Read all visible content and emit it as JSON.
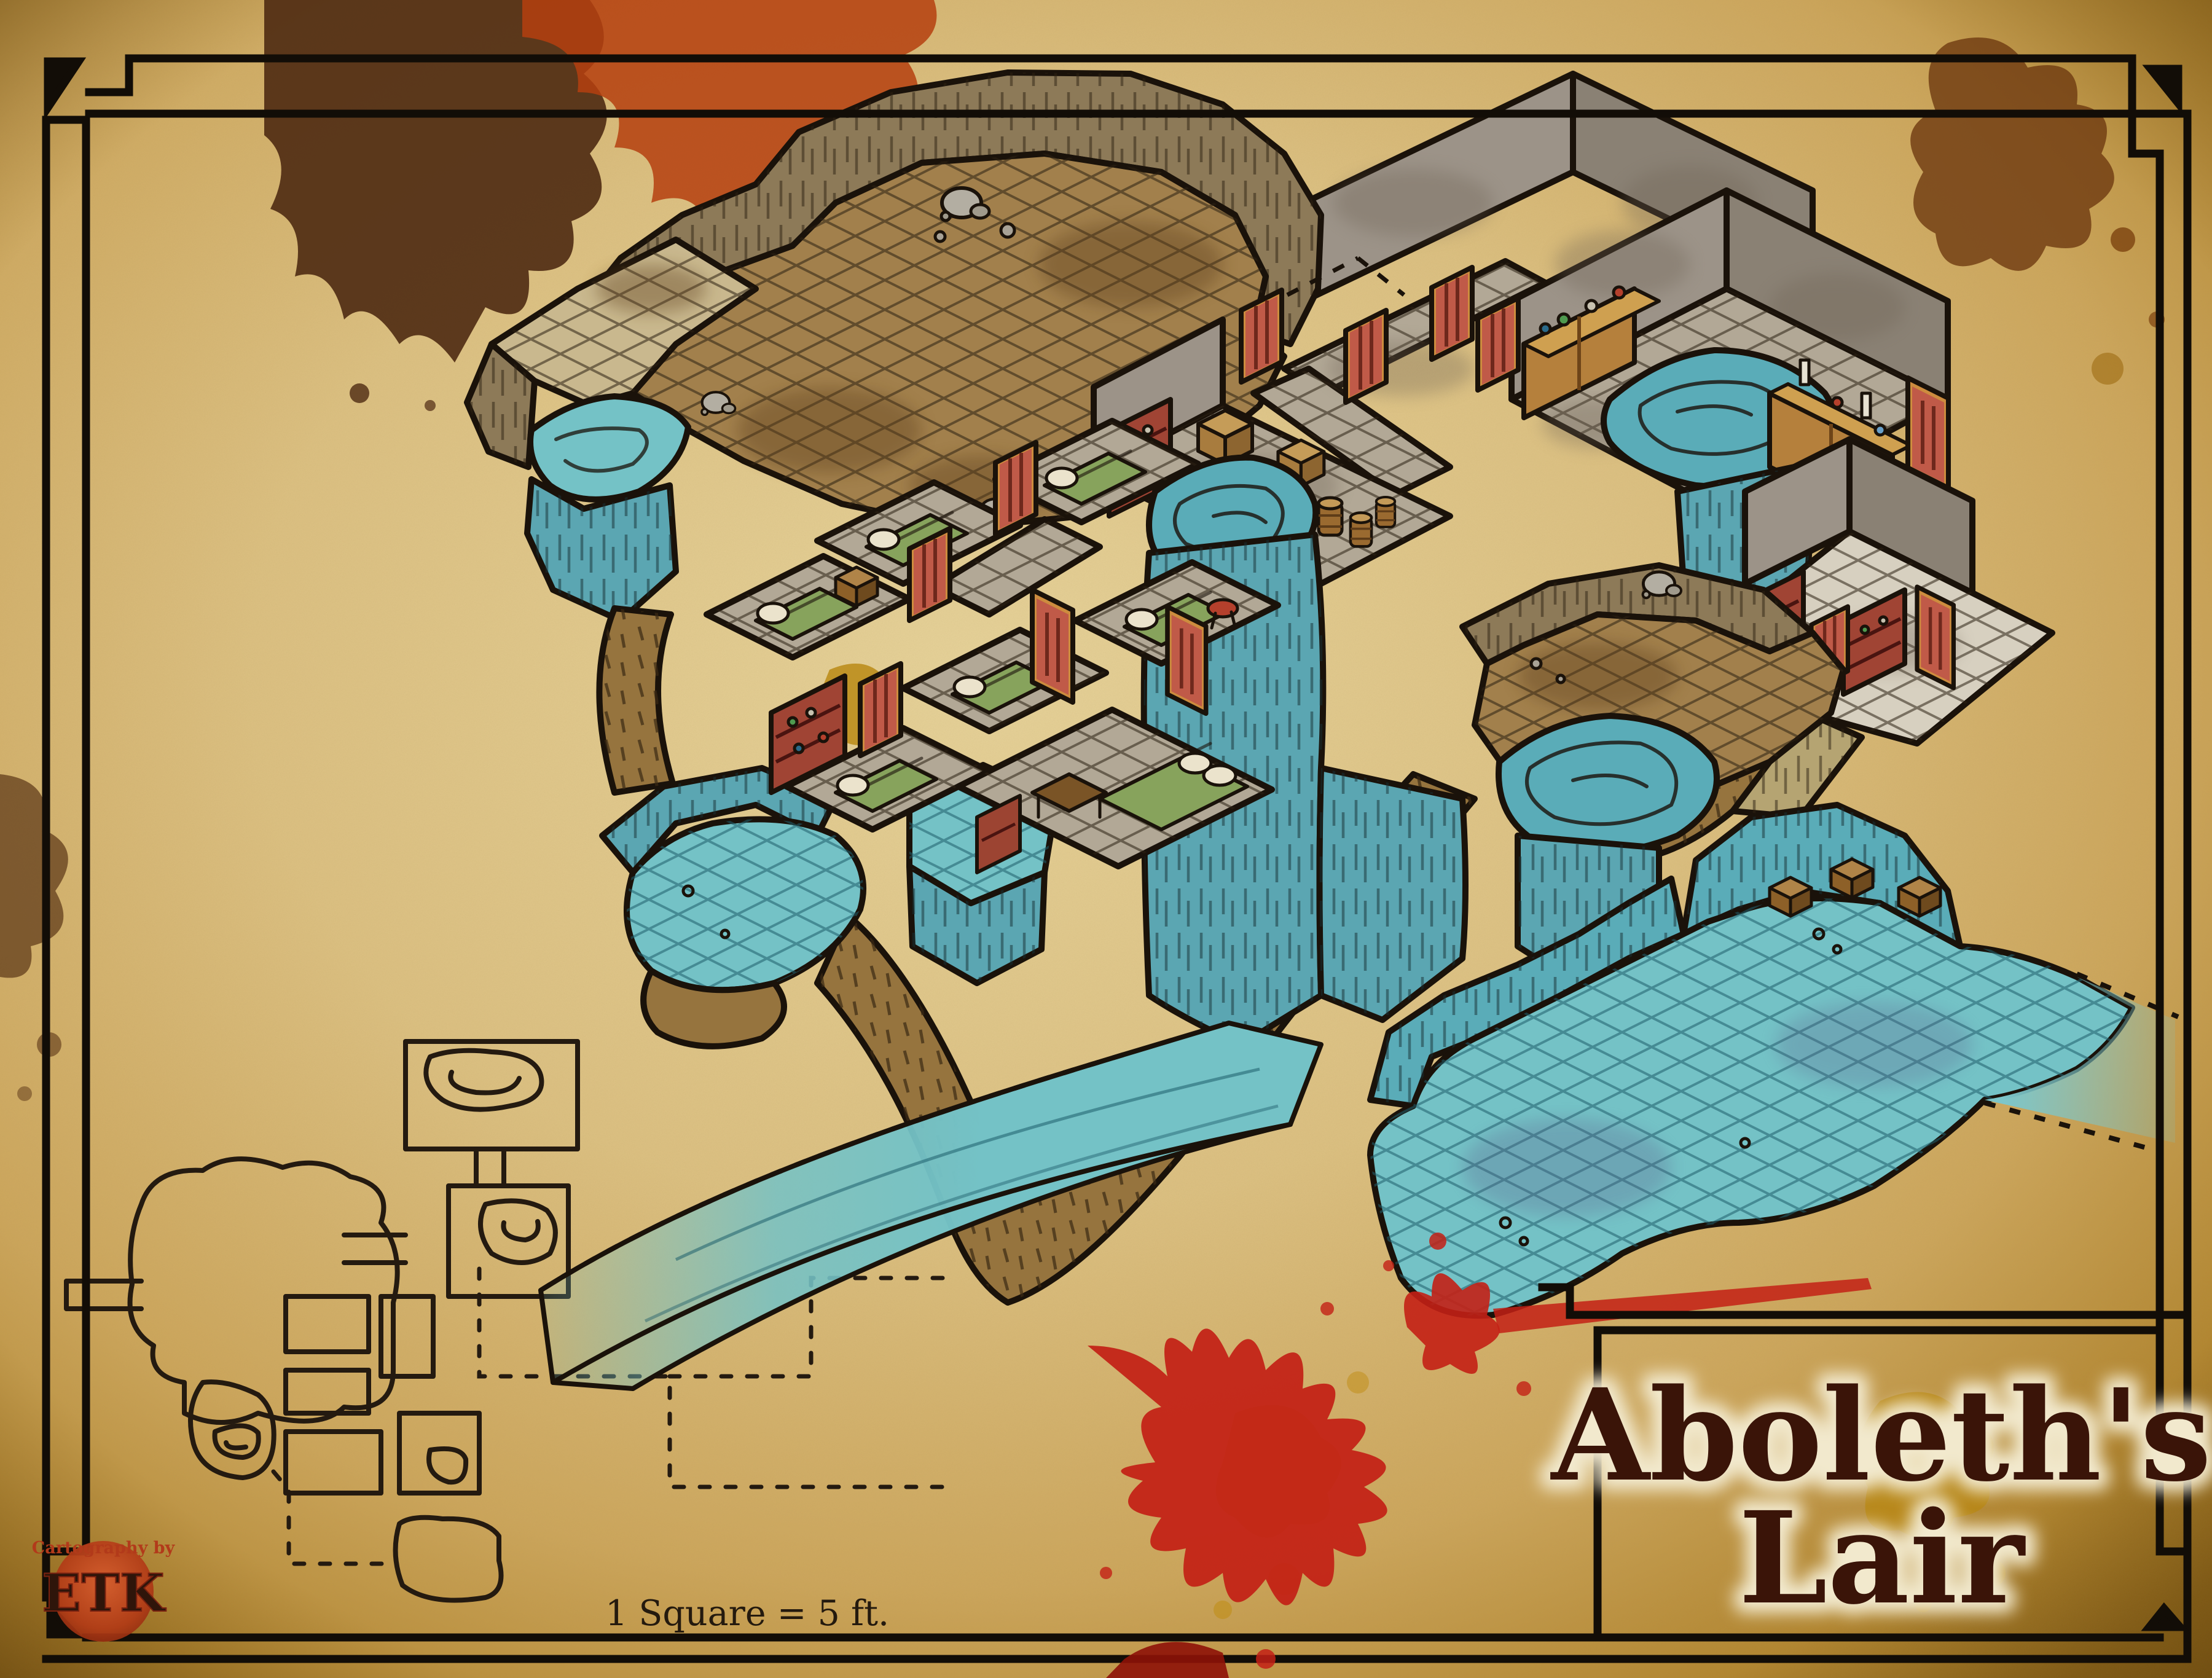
{
  "document": {
    "kind": "fantasy-dungeon-battle-map",
    "style": "hand-drawn isometric watercolor on aged parchment",
    "orientation": "isometric with top-down floor-plan inset"
  },
  "title": {
    "line1": "Aboleth's",
    "line2": "Lair"
  },
  "scale_note": "1 Square = 5 ft.",
  "credit": {
    "prefix": "Cartography by",
    "monogram": "ETK"
  },
  "palette": {
    "parchment_light": "#e7d29a",
    "parchment_dark": "#9c7120",
    "ink": "#1a120a",
    "water": "#74c2c6",
    "water_deep": "#5aacb8",
    "cliff": "#5ba6b2",
    "cave_floor": "#a2804c",
    "stone_floor": "#b2a896",
    "light_floor": "#d7d0c0",
    "rock_wall": "#8d7a58",
    "gray_wall": "#9c9388",
    "dirt_path": "#96743e",
    "door_red": "#c05a48",
    "door_frame": "#cd8c3e",
    "shelf_red": "#a04434",
    "cabinet_orange": "#b5803c",
    "bed_green": "#87a35c",
    "blood_red": "#c32015",
    "stain_brown": "#4e2a12",
    "stain_gold": "#b8860e",
    "title_ink": "#3a1408"
  },
  "map_regions": [
    {
      "name": "entry-cavern",
      "features": [
        "rocky walls",
        "dirt floor grid",
        "boulders",
        "red door",
        "secret-door dashes"
      ]
    },
    {
      "name": "west-ledge",
      "features": [
        "tan platform",
        "ledge pool",
        "teal cliff face"
      ]
    },
    {
      "name": "winding-ledge-path",
      "features": [
        "brown dirt ribbon",
        "hatch marks",
        "V-shaped descent"
      ]
    },
    {
      "name": "pond-platform",
      "features": [
        "gridded pond",
        "teal cliff walls",
        "dirt skirt"
      ]
    },
    {
      "name": "prison-cells",
      "features": [
        "six small stone cells",
        "green beds with pillows",
        "red doors",
        "bookshelf",
        "chest",
        "stool"
      ]
    },
    {
      "name": "bedroom",
      "features": [
        "large green bed",
        "desk and chair",
        "red cabinet"
      ]
    },
    {
      "name": "cells-pond",
      "features": [
        "small pond",
        "hanging waterfall columns"
      ]
    },
    {
      "name": "stone-corridors",
      "features": [
        "gray flagstone tiles",
        "tall gray walls",
        "red doors"
      ]
    },
    {
      "name": "laboratory",
      "features": [
        "stone floor",
        "large pool",
        "two orange cabinets with flasks",
        "red doors"
      ]
    },
    {
      "name": "storage-room",
      "features": [
        "red shelf",
        "crates",
        "barrels",
        "pool",
        "great waterfall"
      ]
    },
    {
      "name": "library",
      "features": [
        "white stone floor",
        "red bookshelves",
        "red doors",
        "dirt ramp"
      ]
    },
    {
      "name": "cave-platform",
      "features": [
        "dirt floor grid",
        "boulder",
        "pool",
        "waterfall to cavern"
      ]
    },
    {
      "name": "flooded-cavern",
      "features": [
        "teal water grid",
        "striated cave walls",
        "three treasure chests",
        "bubbles"
      ]
    },
    {
      "name": "underground-river",
      "features": [
        "southwest channel",
        "dashed map edge",
        "fading tail",
        "east outflow past border"
      ]
    }
  ],
  "floor_plan_inset": {
    "description": "top-down ink plan of the same dungeon",
    "features": [
      "gridded rooms",
      "contour pools",
      "corridors",
      "dashed underwater passages"
    ]
  },
  "decorations": [
    "ornate double-line border with key corners",
    "dark ink splatter top-left",
    "rust-red splatter top-center",
    "brown splatter top-right",
    "bright red blood splatter bottom-center",
    "gold stains",
    "title cartouche"
  ]
}
